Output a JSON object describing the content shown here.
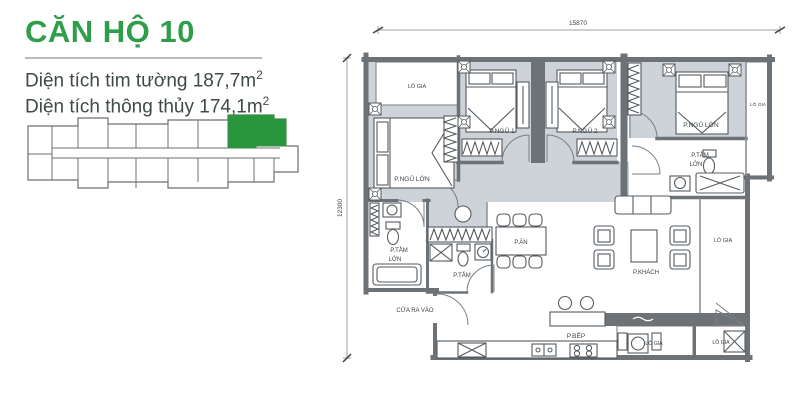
{
  "panel": {
    "title": "CĂN HỘ 10",
    "area_line1": {
      "text": "Diện tích tim tường 187,7m",
      "sup": "2"
    },
    "area_line2": {
      "text": "Diện tích thông thủy 174,1m",
      "sup": "2"
    }
  },
  "colors": {
    "accent_green": "#2f9e4b",
    "unit_green": "#27963d",
    "wall_gray": "#6d7277",
    "room_fill": "#cdd3d9",
    "label_text": "#3c4347"
  },
  "plan": {
    "dimensions": {
      "width_label": "15870",
      "height_label": "12300"
    },
    "labels": [
      {
        "name": "dim-width-label",
        "text": "15870",
        "x": 578,
        "y": 25,
        "size": 6.5
      },
      {
        "name": "dim-height-label",
        "text": "12300",
        "x": 342,
        "y": 208,
        "size": 6.5,
        "rotate": -90
      },
      {
        "name": "label-logia-top-left",
        "text": "LÔ GIA",
        "x": 417,
        "y": 88,
        "size": 5.5
      },
      {
        "name": "label-master-bedroom-left",
        "text": "P.NGỦ LỚN",
        "x": 412,
        "y": 181,
        "size": 6.5
      },
      {
        "name": "label-bedroom-1",
        "text": "P.NGỦ 1",
        "x": 502,
        "y": 133,
        "size": 6.5
      },
      {
        "name": "label-bedroom-2",
        "text": "P.NGỦ 2",
        "x": 585,
        "y": 133,
        "size": 6.5
      },
      {
        "name": "label-master-bedroom-right",
        "text": "P.NGỦ LỚN",
        "x": 701,
        "y": 127,
        "size": 6.5
      },
      {
        "name": "label-logia-right-top",
        "text": "LÔ GIA",
        "x": 758,
        "y": 106,
        "size": 4.8
      },
      {
        "name": "label-bath-large-right-line1",
        "text": "P.TẮM",
        "x": 700,
        "y": 157,
        "size": 6
      },
      {
        "name": "label-bath-large-right-line2",
        "text": "LỚN",
        "x": 696,
        "y": 166,
        "size": 6
      },
      {
        "name": "label-bath-large-left-line1",
        "text": "P.TẮM",
        "x": 399,
        "y": 252,
        "size": 6
      },
      {
        "name": "label-bath-large-left-line2",
        "text": "LỚN",
        "x": 395,
        "y": 261,
        "size": 6
      },
      {
        "name": "label-bath-mid",
        "text": "P.TẮM",
        "x": 462,
        "y": 277,
        "size": 6
      },
      {
        "name": "label-dining",
        "text": "P.ĂN",
        "x": 521,
        "y": 244,
        "size": 6
      },
      {
        "name": "label-living",
        "text": "P.KHÁCH",
        "x": 646,
        "y": 274,
        "size": 6
      },
      {
        "name": "label-logia-right-big",
        "text": "LÔ GIA",
        "x": 723,
        "y": 242,
        "size": 5.5
      },
      {
        "name": "label-entrance",
        "text": "CỬA RA VÀO",
        "x": 415,
        "y": 312,
        "size": 6
      },
      {
        "name": "label-kitchen",
        "text": "P.BẾP",
        "x": 576,
        "y": 338,
        "size": 6.5
      },
      {
        "name": "label-logia-bottom-1",
        "text": "LÔ GIA",
        "x": 654,
        "y": 345,
        "size": 5.2
      },
      {
        "name": "label-logia-bottom-2",
        "text": "LÔ GIA",
        "x": 721,
        "y": 344,
        "size": 5.2
      }
    ]
  }
}
